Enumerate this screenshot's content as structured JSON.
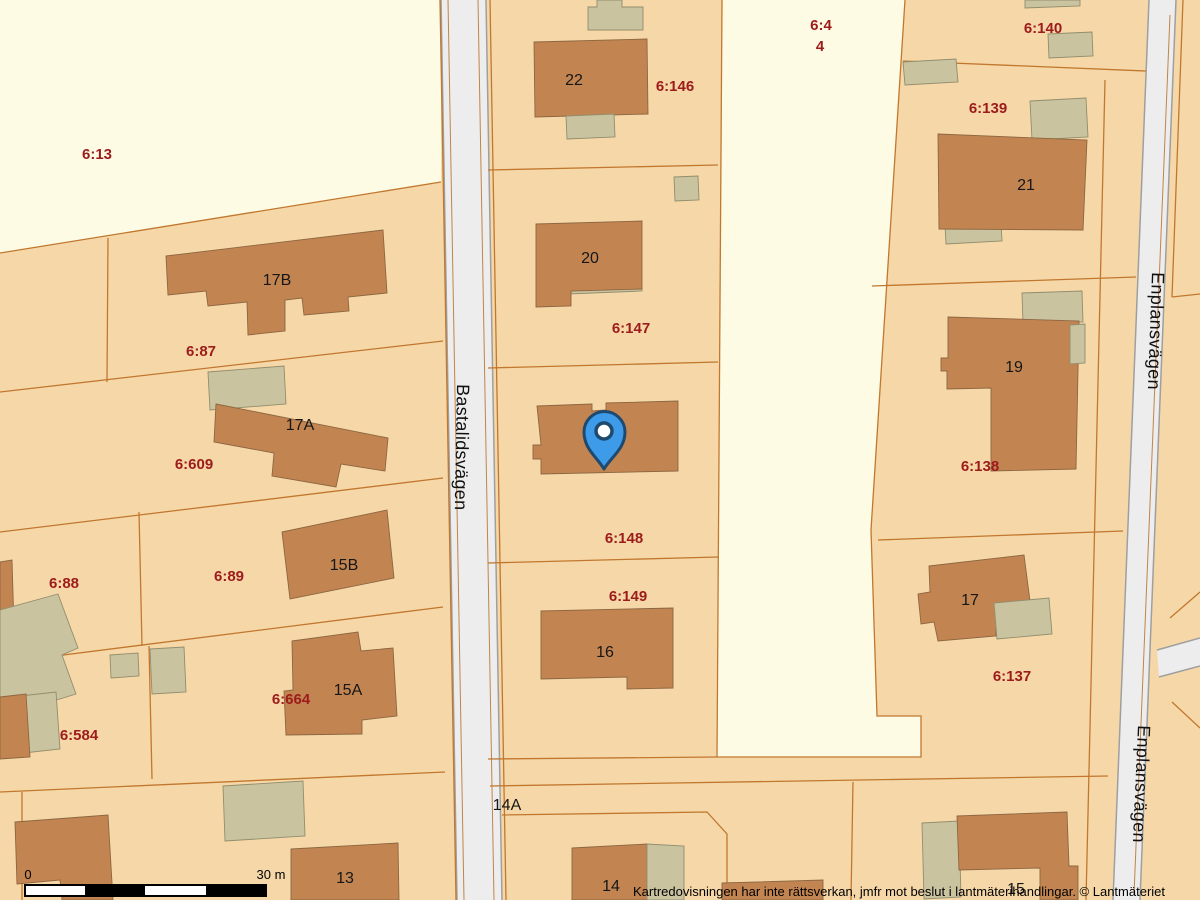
{
  "map": {
    "type": "cadastral-map",
    "attribution": "Kartredovisningen har inte rättsverkan, jmfr mot beslut i lantmäterihandlingar. © Lantmäteriet",
    "streets": {
      "bastalidsvagen": "Bastalidsvägen",
      "enplansvagen": "Enplansvägen"
    },
    "parcel_labels": {
      "p6_13": "6:13",
      "p6_87": "6:87",
      "p6_609": "6:609",
      "p6_88": "6:88",
      "p6_89": "6:89",
      "p6_664": "6:664",
      "p6_584": "6:584",
      "p6_146": "6:146",
      "p6_147": "6:147",
      "p6_148": "6:148",
      "p6_149": "6:149",
      "p6_4": "6:4",
      "p4": "4",
      "p6_140": "6:140",
      "p6_139": "6:139",
      "p6_138": "6:138",
      "p6_137": "6:137"
    },
    "house_numbers": {
      "h22": "22",
      "h20": "20",
      "h18": "18",
      "h16": "16",
      "h17B": "17B",
      "h17A": "17A",
      "h15B": "15B",
      "h15A": "15A",
      "h13": "13",
      "h14": "14",
      "h14A": "14A",
      "h21": "21",
      "h19": "19",
      "h17": "17",
      "h15": "15"
    },
    "scale_bar": {
      "start_label": "0",
      "end_label": "30 m"
    },
    "marker": {
      "name": "location-pin",
      "color": "#3d9be9"
    },
    "colors": {
      "parcel": "#f6d8a8",
      "open_land": "#fdfbe3",
      "building": "#c28551",
      "outbuilding": "#c9c3a0",
      "boundary": "#c1772e",
      "road": "#ededee",
      "label_red": "#9c1b1b",
      "text_black": "#1a1a1a",
      "pin_blue": "#3d9be9"
    }
  }
}
